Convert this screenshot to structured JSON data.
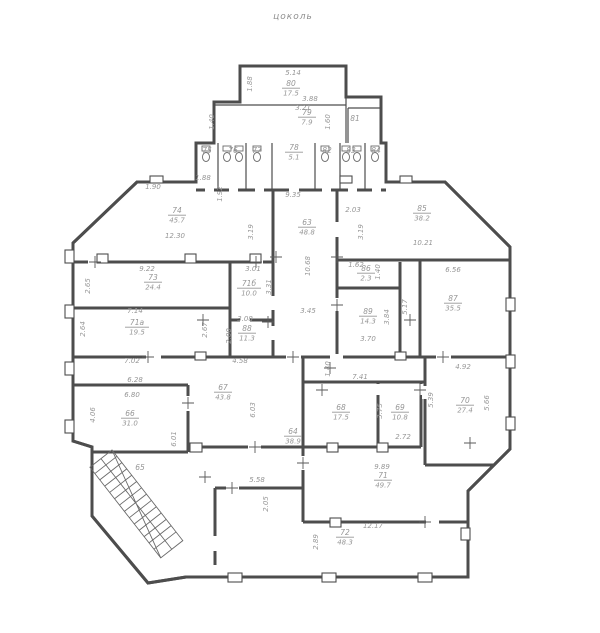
{
  "title": "цоколь",
  "colors": {
    "wall": "#4d4d4d",
    "text": "#969696",
    "background": "#ffffff"
  },
  "plan": {
    "rooms": [
      {
        "num": "80",
        "area": "17.5",
        "x": 291,
        "y": 86
      },
      {
        "num": "79",
        "area": "7.9",
        "x": 307,
        "y": 115
      },
      {
        "num": "81",
        "x": 355,
        "y": 121
      },
      {
        "num": "75",
        "x": 207,
        "y": 153
      },
      {
        "num": "76",
        "x": 233,
        "y": 153
      },
      {
        "num": "77",
        "x": 257,
        "y": 153
      },
      {
        "num": "78",
        "area": "5.1",
        "x": 294,
        "y": 150
      },
      {
        "num": "82",
        "x": 327,
        "y": 153
      },
      {
        "num": "83",
        "x": 351,
        "y": 153
      },
      {
        "num": "84",
        "x": 376,
        "y": 153
      },
      {
        "num": "74",
        "area": "45.7",
        "x": 177,
        "y": 213
      },
      {
        "num": "85",
        "area": "38.2",
        "x": 422,
        "y": 211
      },
      {
        "num": "63",
        "area": "48.8",
        "x": 307,
        "y": 225
      },
      {
        "num": "73",
        "area": "24.4",
        "x": 153,
        "y": 280
      },
      {
        "num": "71б",
        "area": "10.0",
        "x": 249,
        "y": 286
      },
      {
        "num": "86",
        "area": "2.3",
        "x": 366,
        "y": 271
      },
      {
        "num": "71а",
        "area": "19.5",
        "x": 137,
        "y": 325
      },
      {
        "num": "88",
        "area": "11.3",
        "x": 247,
        "y": 331
      },
      {
        "num": "89",
        "area": "14.3",
        "x": 368,
        "y": 314
      },
      {
        "num": "87",
        "area": "35.5",
        "x": 453,
        "y": 301
      },
      {
        "num": "67",
        "area": "43.8",
        "x": 223,
        "y": 390
      },
      {
        "num": "66",
        "area": "31.0",
        "x": 130,
        "y": 416
      },
      {
        "num": "64",
        "area": "38.9",
        "x": 293,
        "y": 434
      },
      {
        "num": "68",
        "area": "17.5",
        "x": 341,
        "y": 410
      },
      {
        "num": "69",
        "area": "10.8",
        "x": 400,
        "y": 410
      },
      {
        "num": "70",
        "area": "27.4",
        "x": 465,
        "y": 403
      },
      {
        "num": "71",
        "area": "49.7",
        "x": 383,
        "y": 478
      },
      {
        "num": "72",
        "area": "48.3",
        "x": 345,
        "y": 535
      },
      {
        "num": "65",
        "x": 140,
        "y": 470
      }
    ],
    "dims": [
      {
        "t": "5.14",
        "x": 293,
        "y": 75
      },
      {
        "t": "1.88",
        "x": 252,
        "y": 84,
        "r": 1
      },
      {
        "t": "3.88",
        "x": 310,
        "y": 101
      },
      {
        "t": "3.21",
        "x": 303,
        "y": 110
      },
      {
        "t": "1.40",
        "x": 214,
        "y": 122,
        "r": 1
      },
      {
        "t": "1.60",
        "x": 330,
        "y": 122,
        "r": 1
      },
      {
        "t": "1.88",
        "x": 203,
        "y": 180
      },
      {
        "t": "1.90",
        "x": 153,
        "y": 189
      },
      {
        "t": "1.92",
        "x": 222,
        "y": 194,
        "r": 1
      },
      {
        "t": "9.35",
        "x": 293,
        "y": 197
      },
      {
        "t": "2.03",
        "x": 353,
        "y": 212
      },
      {
        "t": "3.19",
        "x": 363,
        "y": 232,
        "r": 1
      },
      {
        "t": "3.19",
        "x": 253,
        "y": 232,
        "r": 1
      },
      {
        "t": "12.30",
        "x": 175,
        "y": 238
      },
      {
        "t": "10.21",
        "x": 423,
        "y": 245
      },
      {
        "t": "10.68",
        "x": 310,
        "y": 266,
        "r": 1
      },
      {
        "t": "9.22",
        "x": 147,
        "y": 271
      },
      {
        "t": "2.65",
        "x": 90,
        "y": 286,
        "r": 1
      },
      {
        "t": "3.01",
        "x": 253,
        "y": 271
      },
      {
        "t": "3.31",
        "x": 271,
        "y": 287,
        "r": 1
      },
      {
        "t": "1.62",
        "x": 356,
        "y": 267
      },
      {
        "t": "1.40",
        "x": 380,
        "y": 272,
        "r": 1
      },
      {
        "t": "6.56",
        "x": 453,
        "y": 272
      },
      {
        "t": "7.14",
        "x": 135,
        "y": 313
      },
      {
        "t": "2.64",
        "x": 85,
        "y": 329,
        "r": 1
      },
      {
        "t": "2.67",
        "x": 207,
        "y": 330,
        "r": 1
      },
      {
        "t": "3.08",
        "x": 245,
        "y": 321
      },
      {
        "t": "2.00",
        "x": 231,
        "y": 336,
        "r": 1
      },
      {
        "t": "3.84",
        "x": 389,
        "y": 317,
        "r": 1
      },
      {
        "t": "5.17",
        "x": 407,
        "y": 307,
        "r": 1
      },
      {
        "t": "3.45",
        "x": 308,
        "y": 313
      },
      {
        "t": "3.70",
        "x": 368,
        "y": 341
      },
      {
        "t": "7.02",
        "x": 132,
        "y": 363
      },
      {
        "t": "4.58",
        "x": 240,
        "y": 363
      },
      {
        "t": "1.40",
        "x": 330,
        "y": 369,
        "r": 1
      },
      {
        "t": "4.92",
        "x": 463,
        "y": 369
      },
      {
        "t": "7.41",
        "x": 360,
        "y": 379
      },
      {
        "t": "6.28",
        "x": 135,
        "y": 382
      },
      {
        "t": "6.80",
        "x": 132,
        "y": 397
      },
      {
        "t": "4.06",
        "x": 95,
        "y": 415,
        "r": 1
      },
      {
        "t": "6.01",
        "x": 176,
        "y": 439,
        "r": 1
      },
      {
        "t": "6.03",
        "x": 255,
        "y": 410,
        "r": 1
      },
      {
        "t": "3.75",
        "x": 382,
        "y": 411,
        "r": 1
      },
      {
        "t": "5.39",
        "x": 433,
        "y": 400,
        "r": 1
      },
      {
        "t": "5.66",
        "x": 489,
        "y": 403,
        "r": 1
      },
      {
        "t": "2.72",
        "x": 403,
        "y": 439
      },
      {
        "t": "5.58",
        "x": 257,
        "y": 482
      },
      {
        "t": "2.05",
        "x": 268,
        "y": 504,
        "r": 1
      },
      {
        "t": "9.89",
        "x": 382,
        "y": 469
      },
      {
        "t": "12.17",
        "x": 373,
        "y": 528
      },
      {
        "t": "2.89",
        "x": 318,
        "y": 542,
        "r": 1
      }
    ]
  }
}
